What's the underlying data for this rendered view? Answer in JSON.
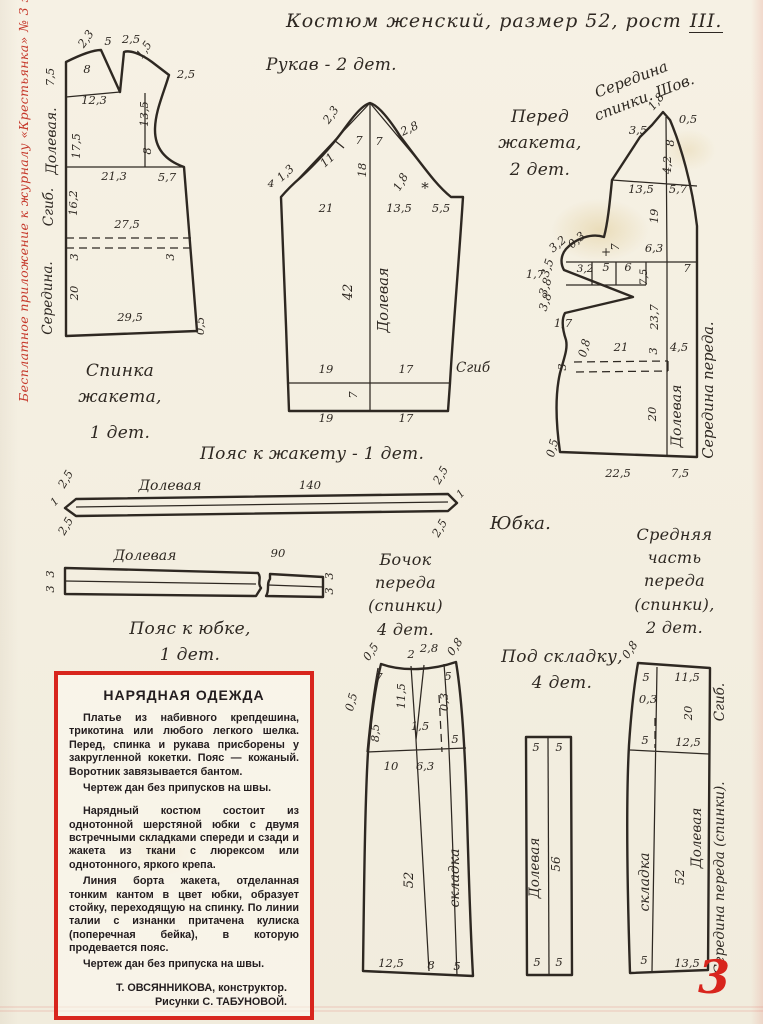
{
  "page": {
    "edge_note": "Бесплатное приложение к журналу «Крестьянка» № 3 за 1961 год.",
    "page_number": "3"
  },
  "header": {
    "title_main": "Костюм женский, размер 52, рост ",
    "title_rost": "III."
  },
  "captions": {
    "sleeve": "Рукав - 2 дет.",
    "back": "Спинка\nжакета,",
    "back_count": "1 дет.",
    "front": "Перед\nжакета,\n2 дет.",
    "jacket_belt": "Пояс к жакету - 1 дет.",
    "skirt": "Юбка.",
    "skirt_belt": "Пояс к юбке,\n1 дет.",
    "side_panel": "Бочок\nпереда\n(спинки)\n4 дет.",
    "center_panel": "Средняя\nчасть\nпереда\n(спинки),\n2 дет.",
    "pleat": "Под складку,\n4 дет."
  },
  "info_box": {
    "title": "НАРЯДНАЯ ОДЕЖДА",
    "paragraphs": [
      "Платье из набивного крепдешина, трикотина или любого легкого шелка. Перед, спинка и рукава присборены у закругленной кокетки. Пояс — кожаный. Воротник завязывается бантом.",
      "Чертеж дан без припусков на швы.",
      "Нарядный костюм состоит из однотонной шерстяной юбки с двумя встречными складками спереди и сзади и жакета из ткани с люрексом или однотонного, яркого крепа.",
      "Линия борта жакета, отделанная тонким кантом в цвет юбки, образует стойку, переходящую на спинку. По линии талии с изнанки притачена кулиска (поперечная бейка), в которую продевается пояс.",
      "Чертеж дан без припуска на швы."
    ],
    "credits": [
      "Т. ОВСЯННИКОВА, конструктор.",
      "Рисунки С. ТАБУНОВОЙ."
    ]
  },
  "diagram_labels": {
    "back": [
      {
        "t": "2,3",
        "x": 89,
        "y": 41,
        "r": -55
      },
      {
        "t": "5",
        "x": 108,
        "y": 45
      },
      {
        "t": "2,5",
        "x": 131,
        "y": 43
      },
      {
        "t": "1,5",
        "x": 147,
        "y": 52,
        "r": -55
      },
      {
        "t": "7,5",
        "x": 54,
        "y": 77,
        "r": -90
      },
      {
        "t": "8",
        "x": 87,
        "y": 73
      },
      {
        "t": "2,5",
        "x": 186,
        "y": 78
      },
      {
        "t": "12,3",
        "x": 94,
        "y": 104
      },
      {
        "t": "13,5",
        "x": 148,
        "y": 114,
        "r": -90
      },
      {
        "t": "17,5",
        "x": 80,
        "y": 146,
        "r": -90
      },
      {
        "t": "8",
        "x": 151,
        "y": 151,
        "r": -90
      },
      {
        "t": "21,3",
        "x": 114,
        "y": 180
      },
      {
        "t": "5,7",
        "x": 167,
        "y": 181
      },
      {
        "t": "16,2",
        "x": 77,
        "y": 203,
        "r": -90
      },
      {
        "t": "27,5",
        "x": 127,
        "y": 228
      },
      {
        "t": "3",
        "x": 78,
        "y": 257,
        "r": -90
      },
      {
        "t": "3",
        "x": 174,
        "y": 257,
        "r": -90
      },
      {
        "t": "20",
        "x": 78,
        "y": 293,
        "r": -90
      },
      {
        "t": "29,5",
        "x": 130,
        "y": 321
      },
      {
        "t": "0,5",
        "x": 204,
        "y": 326,
        "r": -90
      },
      {
        "t": "Долевая.",
        "x": 56,
        "y": 141,
        "r": -90,
        "s": 14,
        "n": "grain-line-label"
      },
      {
        "t": "Сгиб.",
        "x": 53,
        "y": 207,
        "r": -90,
        "s": 13.5,
        "n": "fold-label"
      },
      {
        "t": "Середина.",
        "x": 52,
        "y": 298,
        "r": -90,
        "s": 13.5,
        "n": "center-label"
      }
    ],
    "sleeve": [
      {
        "t": "2,3",
        "x": 334,
        "y": 117,
        "r": -55
      },
      {
        "t": "7",
        "x": 359,
        "y": 144
      },
      {
        "t": "7",
        "x": 379,
        "y": 145
      },
      {
        "t": "2,8",
        "x": 411,
        "y": 132,
        "r": -25
      },
      {
        "t": "11",
        "x": 330,
        "y": 163,
        "r": -42
      },
      {
        "t": "18",
        "x": 366,
        "y": 170,
        "r": -90
      },
      {
        "t": "1,8",
        "x": 404,
        "y": 184,
        "r": -60
      },
      {
        "t": "*",
        "x": 425,
        "y": 193,
        "s": 15
      },
      {
        "t": "4",
        "x": 271,
        "y": 187,
        "s": 10.5
      },
      {
        "t": "1,3",
        "x": 288,
        "y": 176,
        "r": -42
      },
      {
        "t": "21",
        "x": 326,
        "y": 212
      },
      {
        "t": "13,5",
        "x": 399,
        "y": 212
      },
      {
        "t": "5,5",
        "x": 441,
        "y": 212
      },
      {
        "t": "42",
        "x": 352,
        "y": 292,
        "r": -90,
        "s": 13
      },
      {
        "t": "Долевая",
        "x": 388,
        "y": 300,
        "r": -90,
        "s": 14.5,
        "n": "grain-line-label"
      },
      {
        "t": "19",
        "x": 326,
        "y": 373
      },
      {
        "t": "17",
        "x": 406,
        "y": 373
      },
      {
        "t": "Сгиб",
        "x": 456,
        "y": 372,
        "s": 13.5,
        "a": "start",
        "n": "fold-label"
      },
      {
        "t": "7",
        "x": 357,
        "y": 395,
        "r": -90
      },
      {
        "t": "19",
        "x": 326,
        "y": 422
      },
      {
        "t": "17",
        "x": 406,
        "y": 422
      }
    ],
    "front": [
      {
        "t": "Середина",
        "x": 633,
        "y": 84,
        "r": -21,
        "s": 15,
        "n": "center-back-seam-label"
      },
      {
        "t": "спинки. Шов.",
        "x": 646,
        "y": 102,
        "r": -21,
        "s": 15,
        "n": "center-back-seam-label"
      },
      {
        "t": "1,8",
        "x": 659,
        "y": 104,
        "r": -50
      },
      {
        "t": "0,5",
        "x": 688,
        "y": 123
      },
      {
        "t": "3,5",
        "x": 638,
        "y": 134
      },
      {
        "t": "8",
        "x": 674,
        "y": 143,
        "r": -90
      },
      {
        "t": "4,2",
        "x": 671,
        "y": 165,
        "r": -90
      },
      {
        "t": "13,5",
        "x": 641,
        "y": 193
      },
      {
        "t": "5,7",
        "x": 678,
        "y": 193
      },
      {
        "t": "19",
        "x": 658,
        "y": 216,
        "r": -90
      },
      {
        "t": "3,2",
        "x": 560,
        "y": 247,
        "r": -40
      },
      {
        "t": "0,3",
        "x": 579,
        "y": 243,
        "r": -40
      },
      {
        "t": "+",
        "x": 606,
        "y": 256,
        "s": 12
      },
      {
        "t": "7",
        "x": 619,
        "y": 247,
        "r": -90
      },
      {
        "t": "6,3",
        "x": 654,
        "y": 252
      },
      {
        "t": "1,7",
        "x": 535,
        "y": 278
      },
      {
        "t": "3,5",
        "x": 551,
        "y": 269,
        "r": -72
      },
      {
        "t": "3,8",
        "x": 549,
        "y": 288,
        "r": -72
      },
      {
        "t": "3,8",
        "x": 549,
        "y": 303,
        "r": -72
      },
      {
        "t": "3,2",
        "x": 585,
        "y": 272,
        "s": 10.5
      },
      {
        "t": "5",
        "x": 606,
        "y": 271
      },
      {
        "t": "6",
        "x": 628,
        "y": 271
      },
      {
        "t": "7,5",
        "x": 647,
        "y": 277,
        "r": -90,
        "s": 10.5
      },
      {
        "t": "7",
        "x": 687,
        "y": 272
      },
      {
        "t": "23,7",
        "x": 658,
        "y": 317,
        "r": -90
      },
      {
        "t": "1,7",
        "x": 563,
        "y": 327
      },
      {
        "t": "0,8",
        "x": 588,
        "y": 349,
        "r": -75
      },
      {
        "t": "21",
        "x": 621,
        "y": 351
      },
      {
        "t": "3",
        "x": 657,
        "y": 351,
        "r": -90
      },
      {
        "t": "4,5",
        "x": 679,
        "y": 351
      },
      {
        "t": "3",
        "x": 566,
        "y": 367,
        "r": -90
      },
      {
        "t": "20",
        "x": 656,
        "y": 414,
        "r": -90
      },
      {
        "t": "Долевая",
        "x": 681,
        "y": 416,
        "r": -90,
        "s": 14,
        "n": "grain-line-label"
      },
      {
        "t": "Середина переда.",
        "x": 713,
        "y": 390,
        "r": -90,
        "s": 14.5,
        "n": "center-front-label"
      },
      {
        "t": "0,5",
        "x": 556,
        "y": 449,
        "r": -75
      },
      {
        "t": "22,5",
        "x": 618,
        "y": 477
      },
      {
        "t": "7,5",
        "x": 680,
        "y": 477
      }
    ],
    "jacket_belt": [
      {
        "t": "2,5",
        "x": 69,
        "y": 481,
        "r": -60
      },
      {
        "t": "2,5",
        "x": 69,
        "y": 528,
        "r": -60
      },
      {
        "t": "1",
        "x": 57,
        "y": 504,
        "r": -45,
        "s": 10.5
      },
      {
        "t": "Долевая",
        "x": 170,
        "y": 490,
        "s": 14,
        "n": "grain-line-label"
      },
      {
        "t": "140",
        "x": 310,
        "y": 489
      },
      {
        "t": "2,5",
        "x": 444,
        "y": 477,
        "r": -60
      },
      {
        "t": "2,5",
        "x": 443,
        "y": 530,
        "r": -60
      },
      {
        "t": "1",
        "x": 463,
        "y": 496,
        "r": -45,
        "s": 10.5
      }
    ],
    "skirt_belt": [
      {
        "t": "Долевая",
        "x": 145,
        "y": 560,
        "s": 14,
        "n": "grain-line-label"
      },
      {
        "t": "90",
        "x": 278,
        "y": 557
      },
      {
        "t": "3",
        "x": 54,
        "y": 574,
        "r": -90
      },
      {
        "t": "3",
        "x": 54,
        "y": 589,
        "r": -90
      },
      {
        "t": "3",
        "x": 333,
        "y": 576,
        "r": -90
      },
      {
        "t": "3",
        "x": 333,
        "y": 591,
        "r": -90
      }
    ],
    "side_panel": [
      {
        "t": "0,5",
        "x": 374,
        "y": 654,
        "r": -55
      },
      {
        "t": "2",
        "x": 411,
        "y": 658
      },
      {
        "t": "2,8",
        "x": 429,
        "y": 652
      },
      {
        "t": "0,8",
        "x": 458,
        "y": 649,
        "r": -55
      },
      {
        "t": "7",
        "x": 379,
        "y": 681
      },
      {
        "t": "5",
        "x": 448,
        "y": 680
      },
      {
        "t": "11,5",
        "x": 405,
        "y": 696,
        "r": -90
      },
      {
        "t": "0,5",
        "x": 355,
        "y": 703,
        "r": -75
      },
      {
        "t": "0,3",
        "x": 448,
        "y": 702,
        "r": -90
      },
      {
        "t": "1,5",
        "x": 420,
        "y": 730
      },
      {
        "t": "8,5",
        "x": 379,
        "y": 733,
        "r": -90
      },
      {
        "t": "5",
        "x": 455,
        "y": 743
      },
      {
        "t": "10",
        "x": 391,
        "y": 770
      },
      {
        "t": "6,3",
        "x": 425,
        "y": 770
      },
      {
        "t": "52",
        "x": 413,
        "y": 880,
        "r": -90,
        "s": 13
      },
      {
        "t": "складка",
        "x": 459,
        "y": 878,
        "r": -90,
        "s": 14,
        "n": "pleat-label"
      },
      {
        "t": "12,5",
        "x": 391,
        "y": 967
      },
      {
        "t": "8",
        "x": 431,
        "y": 969
      },
      {
        "t": "5",
        "x": 457,
        "y": 970
      }
    ],
    "pleat": [
      {
        "t": "5",
        "x": 536,
        "y": 751
      },
      {
        "t": "5",
        "x": 559,
        "y": 751
      },
      {
        "t": "Долевая",
        "x": 539,
        "y": 868,
        "r": -90,
        "s": 13.5,
        "n": "grain-line-label"
      },
      {
        "t": "56",
        "x": 560,
        "y": 864,
        "r": -90,
        "s": 12
      },
      {
        "t": "5",
        "x": 537,
        "y": 966
      },
      {
        "t": "5",
        "x": 559,
        "y": 966
      }
    ],
    "center_panel": [
      {
        "t": "0,8",
        "x": 633,
        "y": 652,
        "r": -55
      },
      {
        "t": "5",
        "x": 646,
        "y": 681
      },
      {
        "t": "11,5",
        "x": 687,
        "y": 681
      },
      {
        "t": "0,3",
        "x": 648,
        "y": 703
      },
      {
        "t": "20",
        "x": 692,
        "y": 713,
        "r": -90
      },
      {
        "t": "5",
        "x": 645,
        "y": 744
      },
      {
        "t": "12,5",
        "x": 688,
        "y": 746
      },
      {
        "t": "складка",
        "x": 649,
        "y": 882,
        "r": -90,
        "s": 14,
        "n": "pleat-label"
      },
      {
        "t": "52",
        "x": 684,
        "y": 877,
        "r": -90,
        "s": 12.5
      },
      {
        "t": "Долевая",
        "x": 701,
        "y": 838,
        "r": -90,
        "s": 13.5,
        "n": "grain-line-label"
      },
      {
        "t": "Середина переда (спинки).",
        "x": 724,
        "y": 878,
        "r": -90,
        "s": 13.5,
        "n": "center-front-label"
      },
      {
        "t": "Сгиб.",
        "x": 724,
        "y": 702,
        "r": -90,
        "s": 13.5,
        "n": "fold-label"
      },
      {
        "t": "5",
        "x": 644,
        "y": 964
      },
      {
        "t": "13,5",
        "x": 687,
        "y": 967
      }
    ]
  }
}
